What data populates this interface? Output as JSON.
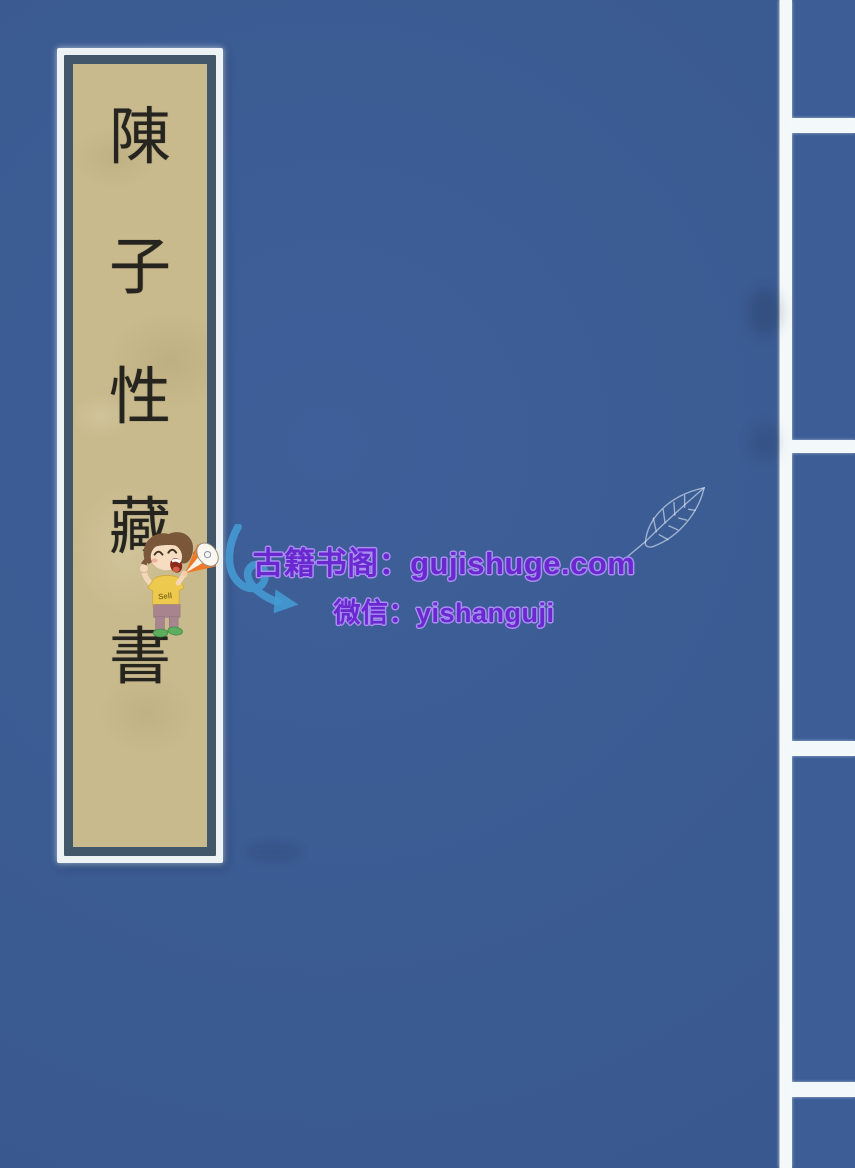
{
  "book_cover": {
    "title_label": {
      "title": "陳子性藏書",
      "characters": [
        "陳",
        "子",
        "性",
        "藏",
        "書"
      ]
    }
  },
  "watermark": {
    "site_line": "古籍书阁：gujishuge.com",
    "wechat_line": "微信：yishanguji",
    "mascot_shirt_text": "Sell",
    "icons": [
      "megaphone-kid-mascot",
      "curved-arrow-icon",
      "leaf-sketch-icon"
    ]
  },
  "colors": {
    "cover_blue": "#3b5b93",
    "panel_blue": "#3c5d96",
    "separator_white": "#f3f9fa",
    "label_paper_tan": "#c9ba8d",
    "label_frame_slate": "#42586a",
    "label_border_white": "#edf3f4",
    "ink_black": "#26241f",
    "watermark_purple": "#6a28d0",
    "watermark_outline_lavender": "#a88ef0",
    "arrow_blue": "#449bd4",
    "megaphone_orange": "#ee7a28"
  }
}
